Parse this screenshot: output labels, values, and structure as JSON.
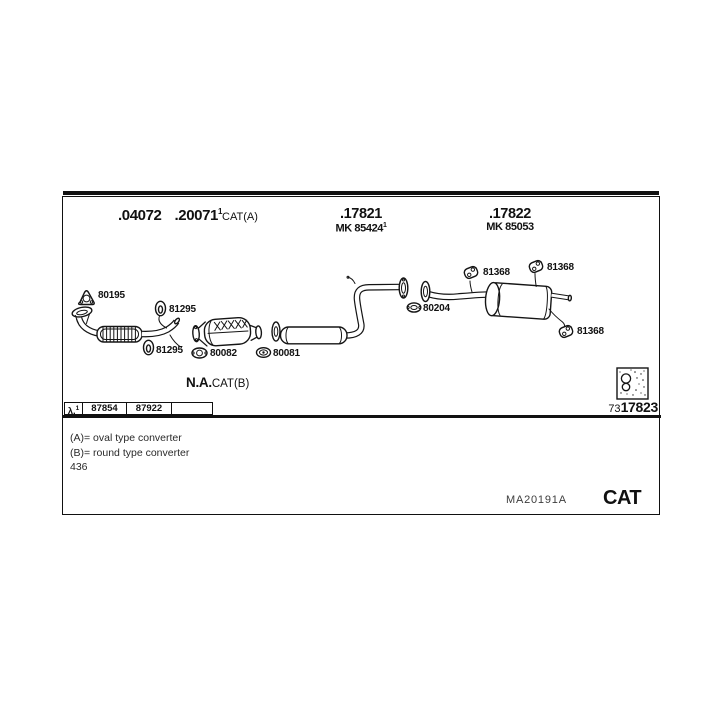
{
  "header": {
    "a_part1": ".04072",
    "a_part2": ".20071",
    "a_sup": "1",
    "a_note": "CAT(A)",
    "b_part": ".17821",
    "b_mk": "MK 85424",
    "b_sup": "1",
    "c_part": ".17822",
    "c_mk": "MK 85053"
  },
  "diagram": {
    "labels": [
      "80195",
      "81295",
      "81295",
      "80082",
      "80081",
      "80204",
      "81368",
      "81368",
      "81368"
    ],
    "na": "N.A.",
    "na_note": "CAT(B)"
  },
  "lambda_row": {
    "lambda": "λ.",
    "sup": "1",
    "cell1": "87854",
    "cell2": "87922",
    "cell3": ""
  },
  "ref_number": {
    "prefix": "73",
    "main": "17823"
  },
  "footnotes": {
    "a": "(A)= oval type converter",
    "b": "(B)= round type converter",
    "page": "436"
  },
  "footer": {
    "doc_code": "MA20191A",
    "brand": "CAT"
  },
  "colors": {
    "ink": "#111111",
    "paper": "#ffffff"
  }
}
